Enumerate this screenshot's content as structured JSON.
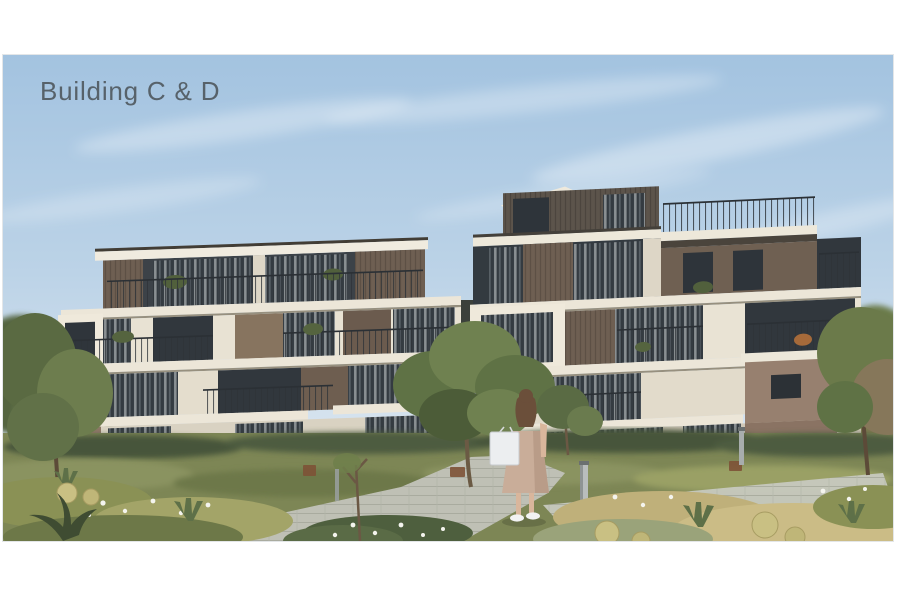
{
  "slide": {
    "title": "Building C & D"
  },
  "image": {
    "alt": "Architectural rendering of two modern terraced apartment buildings (C and D) with stepped white balconies, dark glazing and wood panels, desert-style landscaping, a paved stone walkway, light bollards, and a woman seen from behind carrying a white tote bag",
    "palette": {
      "title_text": "#57626a",
      "sky_top": "#a3c3e0",
      "sky_horizon": "#e9f1f6",
      "facade_cream": "#ece6d8",
      "facade_taupe": "#8c7866",
      "panel_brown": "#6e5f52",
      "wall_mauve": "#97806f",
      "glass_dark": "#31373d",
      "foliage_green": "#5f7245",
      "grass_gold": "#bfb07a",
      "path_stone": "#c7c9be",
      "dress_beige": "#c9ad99",
      "bag_white": "#eceef0"
    }
  }
}
